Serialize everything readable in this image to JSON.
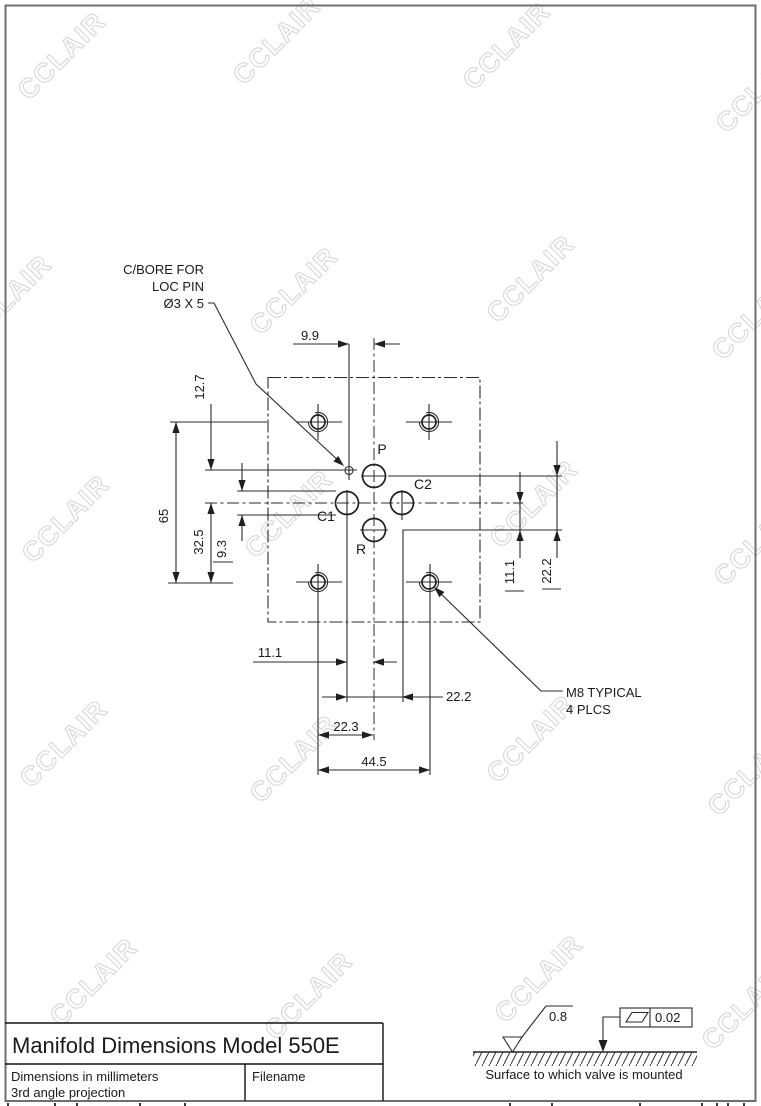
{
  "watermark": {
    "text": "CCLAIR"
  },
  "callouts": {
    "cbore_line1": "C/BORE FOR",
    "cbore_line2": "LOC PIN",
    "cbore_line3": "Ø3 X 5",
    "m8_line1": "M8 TYPICAL",
    "m8_line2": "4 PLCS"
  },
  "ports": {
    "p": "P",
    "c1": "C1",
    "c2": "C2",
    "r": "R"
  },
  "dims": {
    "top_pin_to_center": "9.9",
    "pin_below_top": "12.7",
    "bolt_vertical_spacing": "65",
    "center_to_bolt_row": "32.5",
    "port_diameter": "9.3",
    "center_to_r": "11.1",
    "p_to_r": "22.2",
    "c1_to_center": "11.1",
    "c1_to_c2": "22.2",
    "bolt_to_center": "22.3",
    "bolt_horizontal_spacing": "44.5"
  },
  "title_block": {
    "title": "Manifold Dimensions Model 550E",
    "note_line1": "Dimensions in millimeters",
    "note_line2": "3rd angle projection",
    "filename_label": "Filename"
  },
  "mounting": {
    "roughness": "0.8",
    "flatness": "0.02",
    "caption": "Surface to which valve is mounted"
  }
}
